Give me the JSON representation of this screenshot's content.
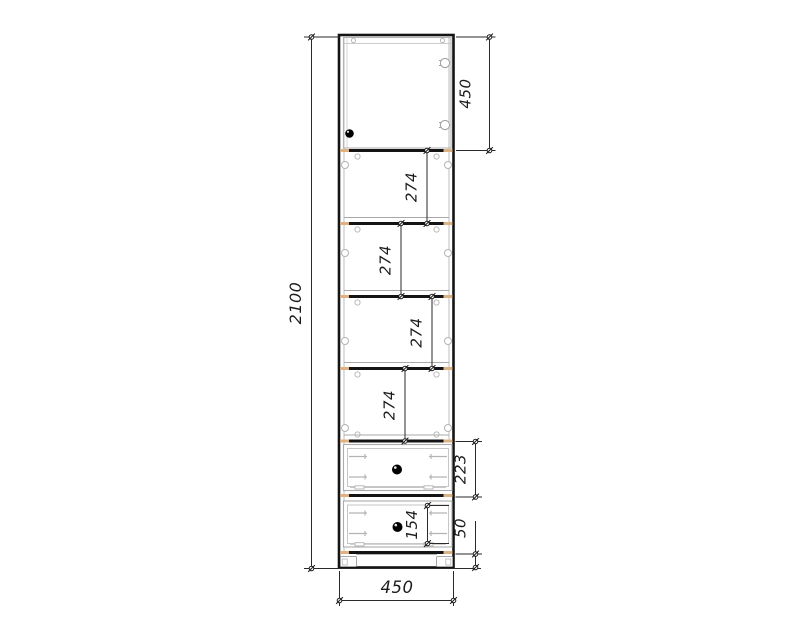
{
  "drawing": {
    "description": "technical elevation drawing of a tall cabinet with door, four shelf sections, two drawers and plinth",
    "dim_labels": {
      "overall_height": "2100",
      "door_height": "450",
      "shelf_1": "274",
      "shelf_2": "274",
      "shelf_3": "274",
      "shelf_4": "274",
      "drawer_top_height": "223",
      "drawer_bottom_front": "154",
      "plinth_height": "50",
      "overall_width": "450"
    },
    "colors": {
      "outline": "#141414",
      "dim_line": "#2a2a2a",
      "detail_gray": "#b3b3b3",
      "edge_band": "#ddb285",
      "knob": "#000000",
      "background": "#ffffff"
    }
  }
}
